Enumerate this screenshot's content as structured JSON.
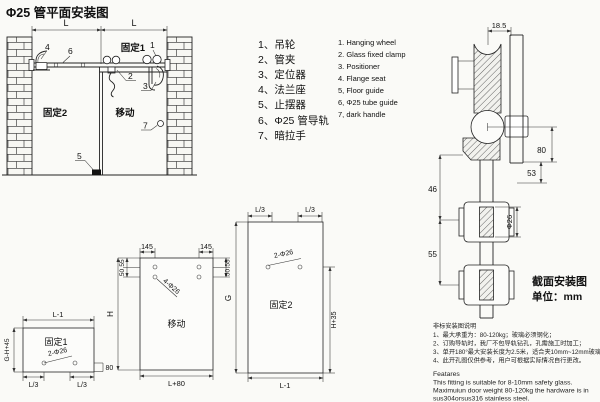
{
  "title": "Φ25 管平面安装图",
  "plan": {
    "dim_l_left": "L",
    "dim_l_right": "L",
    "fixed2": "固定2",
    "moving": "移动",
    "fixed1": "固定1",
    "c1": "1",
    "c2": "2",
    "c3": "3",
    "c4": "4",
    "c5": "5",
    "c6": "6",
    "c7": "7"
  },
  "legend": {
    "zh": [
      "1、吊轮",
      "2、管夹",
      "3、定位器",
      "4、法兰座",
      "5、止摆器",
      "6、Φ25 管导轨",
      "7、暗拉手"
    ],
    "en": [
      "1. Hanging wheel",
      "2. Glass fixed clamp",
      "3. Positioner",
      "4. Flange seat",
      "5, Floor guide",
      "6, Φ25 tube guide",
      "7, dark handle"
    ]
  },
  "section": {
    "dim_top": "18.5",
    "dim_80": "80",
    "dim_53": "53",
    "dim_46": "46",
    "dim_55": "55",
    "dim_phi": "Φ26",
    "caption": "截面安装图",
    "unit": "单位：mm"
  },
  "fixed1_panel": {
    "label": "固定1",
    "dim_top": "L-1",
    "dim_left": "G-H+45",
    "holes": "2-Φ26",
    "dim_bl": "L/3",
    "dim_br": "L/3",
    "dim_right": "80"
  },
  "moving_panel": {
    "label": "移动",
    "dim_145_l": "145",
    "dim_145_r": "145",
    "dim_55": "55",
    "dim_50": "50",
    "holes": "4-Φ26",
    "dim_h": "H",
    "dim_bottom": "L+80"
  },
  "fixed2_panel": {
    "label": "固定2",
    "dim_l3_l": "L/3",
    "dim_l3_r": "L/3",
    "holes": "2-Φ26",
    "dim_g": "G",
    "dim_h35": "H+35",
    "dim_bottom": "L-1"
  },
  "notes": {
    "zh_title": "非标安装图说明",
    "zh": [
      "1、最大承重为：80-120kg；玻璃必须钢化；",
      "2、订购导轨时，我厂不包导轨钻孔，孔需施工时加工；",
      "3、单开180°最大安装长度为2.5米，适合夹10mm~12mm玻璃；",
      "4、此开孔图仅供参考，用户可根据实际情况自行更改。"
    ],
    "en_title": "Featares",
    "en": [
      "This fitting is suitable for 8-10mm safety glass.",
      "Maximuiun door weight 80-120kg the hardware is in",
      "sus304orsus316 stainless steel."
    ]
  }
}
